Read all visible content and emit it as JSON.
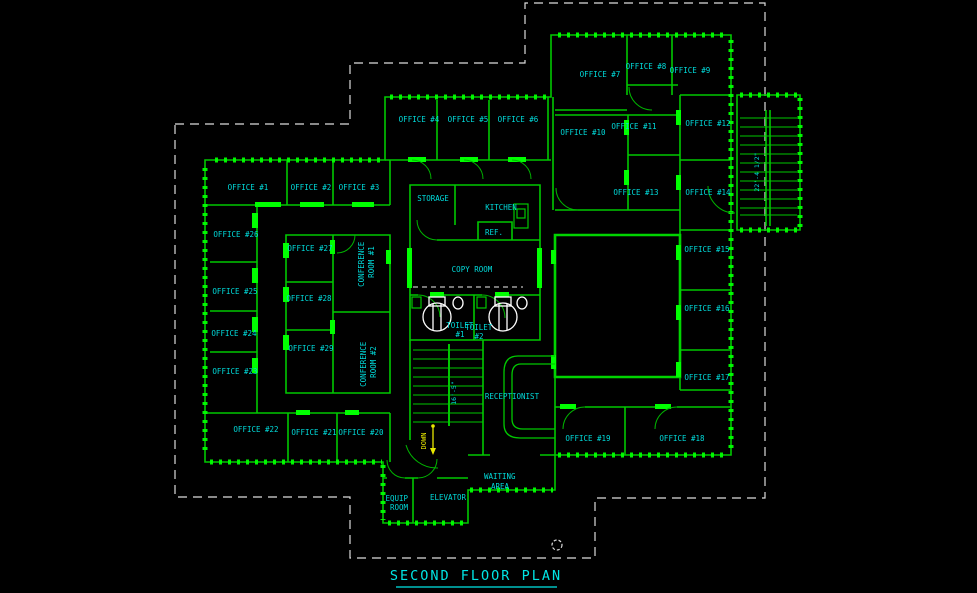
{
  "colors": {
    "background": "#000000",
    "wall_green": "#00C800",
    "bright_green": "#00FF00",
    "label_cyan": "#00DCDC",
    "down_yellow": "#E8E800",
    "boundary_white": "#DCDCDC"
  },
  "title": {
    "text": "SECOND FLOOR PLAN"
  },
  "offices": [
    "OFFICE #1",
    "OFFICE #2",
    "OFFICE #3",
    "OFFICE #4",
    "OFFICE #5",
    "OFFICE #6",
    "OFFICE #7",
    "OFFICE #8",
    "OFFICE #9",
    "OFFICE #10",
    "OFFICE #11",
    "OFFICE #12",
    "OFFICE #13",
    "OFFICE #14",
    "OFFICE #15",
    "OFFICE #16",
    "OFFICE #17",
    "OFFICE #18",
    "OFFICE #19",
    "OFFICE #20",
    "OFFICE #21",
    "OFFICE #22",
    "OFFICE #23",
    "OFFICE #24",
    "OFFICE #25",
    "OFFICE #26",
    "OFFICE #27",
    "OFFICE #28",
    "OFFICE #29"
  ],
  "rooms": {
    "storage": "STORAGE",
    "kitchen": "KITCHEN",
    "refrigerator": "REF.",
    "copy_room": "COPY ROOM",
    "toilet1": {
      "line1": "TOILET",
      "line2": "#1"
    },
    "toilet2": {
      "line1": "TOILET",
      "line2": "#2"
    },
    "receptionist": "RECEPTIONIST",
    "waiting_area": {
      "line1": "WAITING",
      "line2": "AREA"
    },
    "elevator": "ELEVATOR",
    "equip_room": {
      "line1": "EQUIP",
      "line2": "ROOM"
    },
    "conference_room1": {
      "line1": "CONFERENCE",
      "line2": "ROOM #1"
    },
    "conference_room2": {
      "line1": "CONFERENCE",
      "line2": "ROOM #2"
    }
  },
  "stairs": {
    "down_label": "DOWN",
    "interior_stair_dimension": "16'-5\"",
    "exterior_stair_dimension": "22'-4 1/2\""
  }
}
